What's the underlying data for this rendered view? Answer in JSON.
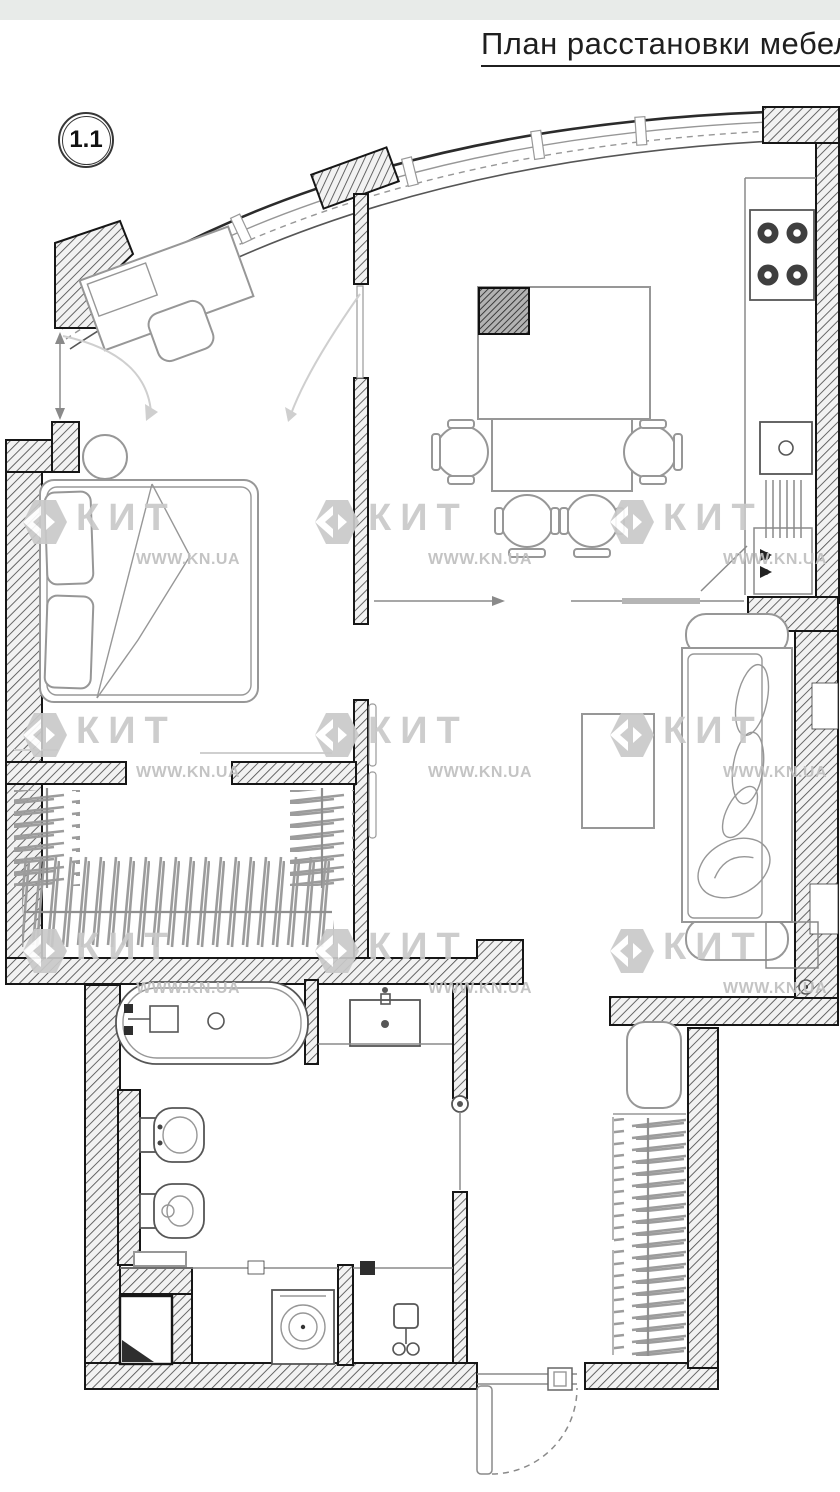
{
  "page": {
    "width": 840,
    "height": 1492
  },
  "header": {
    "title": "План расстановки мебели"
  },
  "plan_badge": {
    "number": "1.1"
  },
  "watermark": {
    "brand": "КИТ",
    "url": "WWW.KN.UA",
    "units": [
      {
        "x": 20,
        "y": 497
      },
      {
        "x": 312,
        "y": 497
      },
      {
        "x": 607,
        "y": 497
      },
      {
        "x": 20,
        "y": 710
      },
      {
        "x": 312,
        "y": 710
      },
      {
        "x": 607,
        "y": 710
      },
      {
        "x": 20,
        "y": 926
      },
      {
        "x": 312,
        "y": 926
      },
      {
        "x": 607,
        "y": 926
      }
    ]
  },
  "colors": {
    "plan_bg": "#ffffff",
    "top_strip": "#e8ebe9",
    "title_text": "#1f1f1f",
    "badge_ring": "#373737",
    "badge_text": "#111111",
    "wall_stroke": "#161616",
    "hatch_line": "#4d4d4d",
    "hatch_bg": "#f2f2f2",
    "hatch_dark_bg": "#b2b2b2",
    "hatch_dark_line": "#2d2d2d",
    "furniture_line": "#979797",
    "fixture_line": "#565656",
    "thin_line": "#8a8a8a",
    "light_line": "#cfcfcf",
    "rack_line": "#9c9c9c",
    "watermark_text": "#c9c9c9",
    "watermark_url": "#c0c0c0"
  }
}
